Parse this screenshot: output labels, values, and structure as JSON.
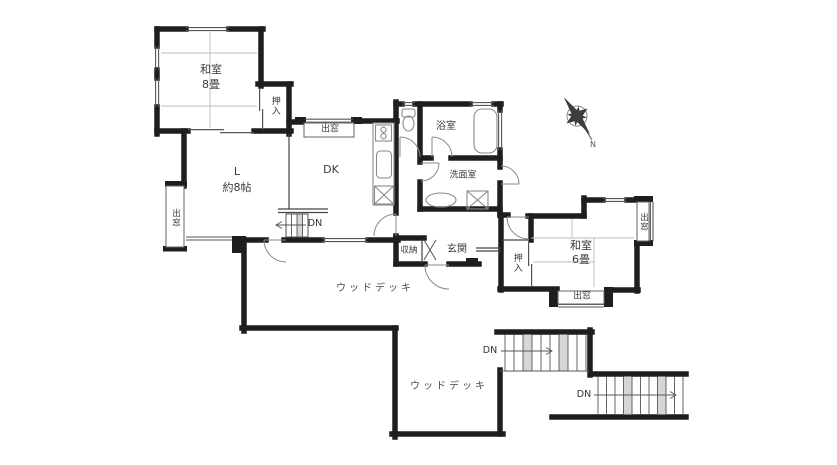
{
  "floorplan": {
    "rooms": {
      "japanese_room_8": {
        "name": "和室",
        "size": "8畳"
      },
      "living": {
        "abbr": "L",
        "size": "約8帖"
      },
      "dining_kitchen": {
        "abbr": "DK"
      },
      "bathroom": {
        "name": "浴室"
      },
      "washroom": {
        "name": "洗面室"
      },
      "toilet": {
        "name": ""
      },
      "storage": {
        "name": "収納"
      },
      "entrance": {
        "name": "玄関"
      },
      "japanese_room_6": {
        "name": "和室",
        "size": "6畳"
      },
      "closet_north": {
        "name": "押入"
      },
      "closet_east": {
        "name": "押入"
      }
    },
    "bay_windows": [
      {
        "label": "出窓",
        "location": "dk-north"
      },
      {
        "label": "出窓",
        "location": "living-west"
      },
      {
        "label": "出窓",
        "location": "room6-east"
      },
      {
        "label": "出窓",
        "location": "room6-south"
      }
    ],
    "decks": [
      {
        "label": "ウッドデッキ",
        "location": "upper"
      },
      {
        "label": "ウッドデッキ",
        "location": "lower"
      }
    ],
    "stairs": [
      {
        "label": "DN",
        "location": "interior-living"
      },
      {
        "label": "DN",
        "location": "exterior-upper"
      },
      {
        "label": "DN",
        "location": "exterior-lower"
      }
    ],
    "compass": {
      "north": "N"
    },
    "colors": {
      "wall": "#1e1e1e",
      "window_line": "#555555",
      "tatami_line": "#b8b8b8",
      "fixture": "#8a8a8a",
      "step_shade": "#d6d6d6",
      "text": "#3a3a3a"
    }
  }
}
